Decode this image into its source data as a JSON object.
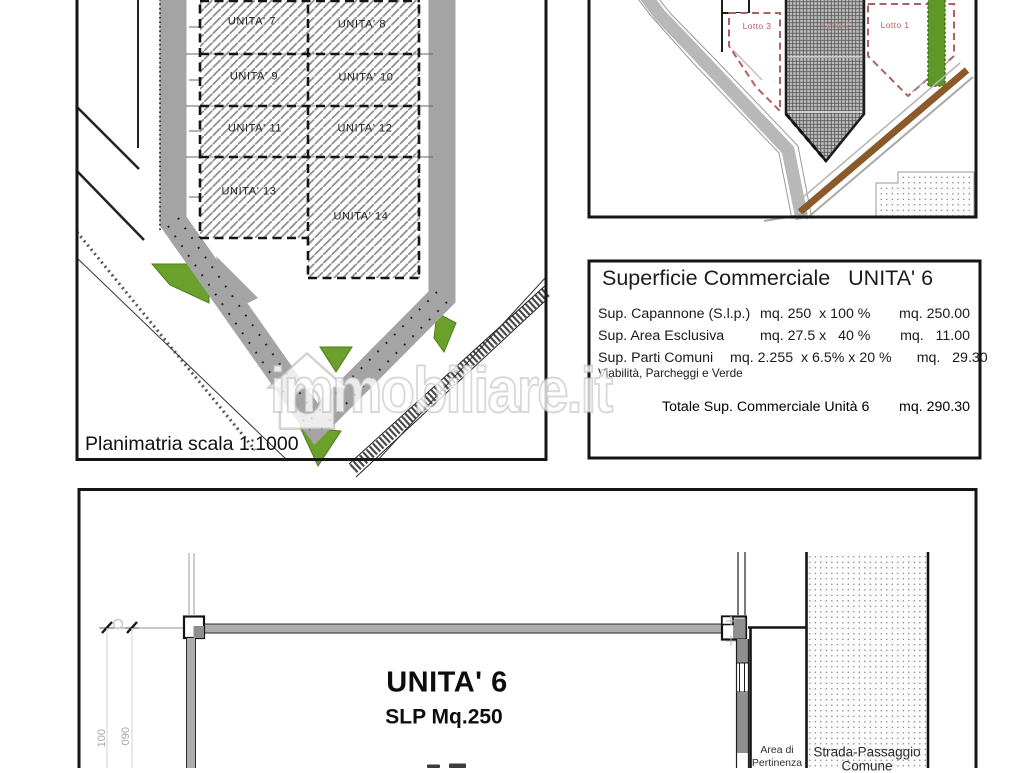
{
  "watermark": {
    "text": "immobiliare.it",
    "icon": "house-icon"
  },
  "colors": {
    "road_gray": "#a4a4a4",
    "green_area": "#6aa02b",
    "brown_road": "#8a5a2a",
    "lot_label_red": "#b55b5b",
    "line_black": "#141414"
  },
  "site_plan": {
    "caption": "Planimatria scala 1:1000",
    "units": [
      {
        "label": "UNITA' 7"
      },
      {
        "label": "UNITA' 8"
      },
      {
        "label": "UNITA' 9"
      },
      {
        "label": "UNITA' 10"
      },
      {
        "label": "UNITA' 11"
      },
      {
        "label": "UNITA' 12"
      },
      {
        "label": "UNITA' 13"
      },
      {
        "label": "UNITA' 14"
      }
    ]
  },
  "location_map": {
    "lots": [
      {
        "label": "Lotto 3"
      },
      {
        "label": "Lotto 2"
      },
      {
        "label": "Lotto 1"
      }
    ]
  },
  "surface_table": {
    "title": "Superficie Commerciale   UNITA' 6",
    "rows": [
      {
        "label": "Sup. Capannone (S.l.p.)",
        "calc": "mq. 250  x 100 %",
        "result": "mq. 250.00"
      },
      {
        "label": "Sup. Area Esclusiva",
        "calc": "mq. 27.5 x   40 %",
        "result": "mq.   11.00"
      },
      {
        "label": "Sup. Parti Comuni",
        "calc": "mq. 2.255  x 6.5% x 20 %",
        "result": "mq.   29.30"
      }
    ],
    "note": "Viabilità, Parcheggi e Verde",
    "total_label": "Totale Sup. Commerciale Unità 6",
    "total_value": "mq. 290.30"
  },
  "floor_plan": {
    "title": "UNITA' 6",
    "subtitle": "SLP Mq.250",
    "area_label_line1": "Area di",
    "area_label_line2": "Pertinenza",
    "road_label_line1": "Strada-Passaggio",
    "road_label_line2": "Comune",
    "dim_1": "100",
    "dim_2": "090"
  }
}
